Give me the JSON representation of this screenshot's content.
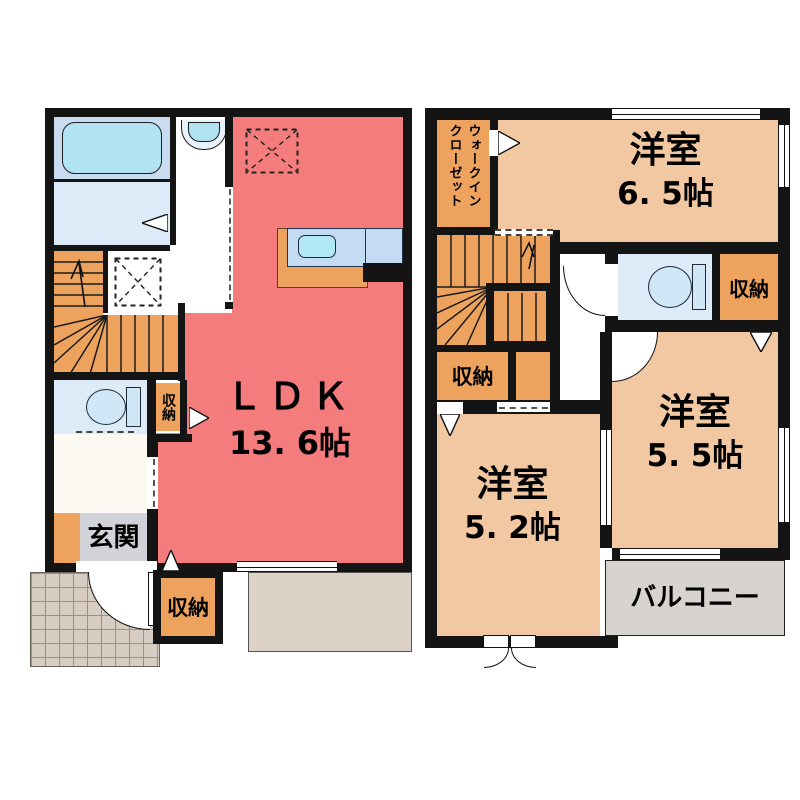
{
  "title": "2-story residence floor plan",
  "palette": {
    "wall": "#141414",
    "ldk_fill": "#f47c7c",
    "bedroom_fill": "#f2c8a2",
    "storage_fill": "#eda35d",
    "wet_room_fill": "#dcebf7",
    "bath_fill": "#c9dcf1",
    "fixture_blue": "#b4e4f3",
    "porch_fill": "#d8cdc2",
    "terrace_fill": "#dcd1c5",
    "balcony_fill": "#d7d4cf"
  },
  "floor1": {
    "ldk": {
      "name": "ＬＤＫ",
      "size": "13. 6帖"
    },
    "entrance_label": "玄関",
    "storage_hall_label": "収納",
    "storage_south_label": "収納"
  },
  "floor2": {
    "walk_in_closet": {
      "line1": "ウォークイン",
      "line2": "クローゼット"
    },
    "room_north": {
      "name": "洋室",
      "size": "6. 5帖"
    },
    "room_east": {
      "name": "洋室",
      "size": "5. 5帖"
    },
    "room_south": {
      "name": "洋室",
      "size": "5. 2帖"
    },
    "storage_stairs_label": "収納",
    "storage_wc_label": "収納",
    "balcony_label": "バルコニー"
  }
}
